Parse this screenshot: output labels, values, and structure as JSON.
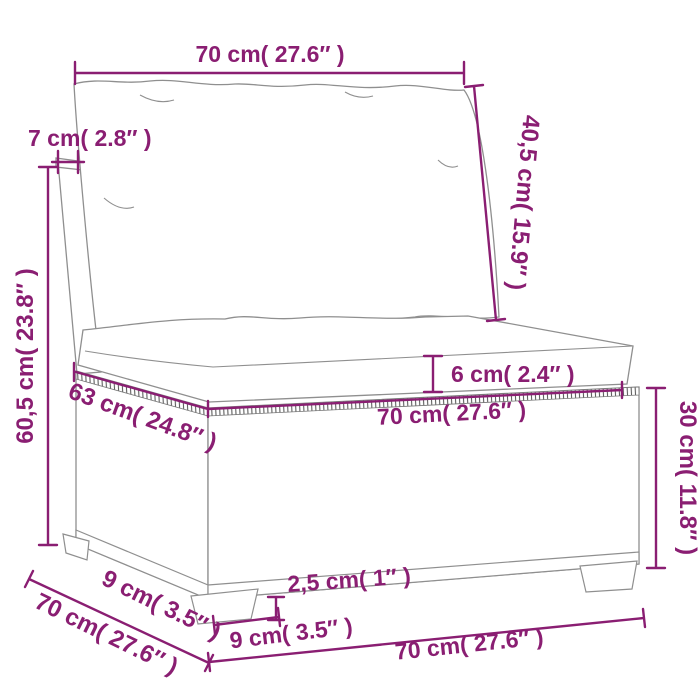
{
  "diagram": {
    "type": "product-dimension-diagram",
    "product": "poly rattan sectional sofa middle section with back and seat cushions",
    "accent_color": "#8a1e72",
    "outline_color": "#8f8f8f",
    "weave_stroke_color": "#686868",
    "labels": {
      "top_width": {
        "text": "70 cm( 27.6″ )",
        "cm": 70,
        "inches": 27.6
      },
      "back_panel_thickness": {
        "text": "7 cm( 2.8″ )",
        "cm": 7,
        "inches": 2.8
      },
      "overall_height": {
        "text": "60,5 cm( 23.8″ )",
        "cm": 60.5,
        "inches": 23.8
      },
      "backrest_cushion_height": {
        "text": "40,5 cm( 15.9″ )",
        "cm": 40.5,
        "inches": 15.9
      },
      "seat_cushion_thickness": {
        "text": "6 cm( 2.4″ )",
        "cm": 6,
        "inches": 2.4
      },
      "seat_depth": {
        "text": "63 cm( 24.8″ )",
        "cm": 63,
        "inches": 24.8
      },
      "seat_width": {
        "text": "70 cm( 27.6″ )",
        "cm": 70,
        "inches": 27.6
      },
      "base_height": {
        "text": "30 cm( 11.8″ )",
        "cm": 30,
        "inches": 11.8
      },
      "plinth_height": {
        "text": "2,5 cm( 1″ )",
        "cm": 2.5,
        "inches": 1
      },
      "side_foot_depth": {
        "text": "9 cm( 3.5″ )",
        "cm": 9,
        "inches": 3.5
      },
      "front_foot_width": {
        "text": "9 cm( 3.5″ )",
        "cm": 9,
        "inches": 3.5
      },
      "overall_depth": {
        "text": "70 cm( 27.6″ )",
        "cm": 70,
        "inches": 27.6
      },
      "overall_width": {
        "text": "70 cm( 27.6″ )",
        "cm": 70,
        "inches": 27.6
      }
    }
  }
}
